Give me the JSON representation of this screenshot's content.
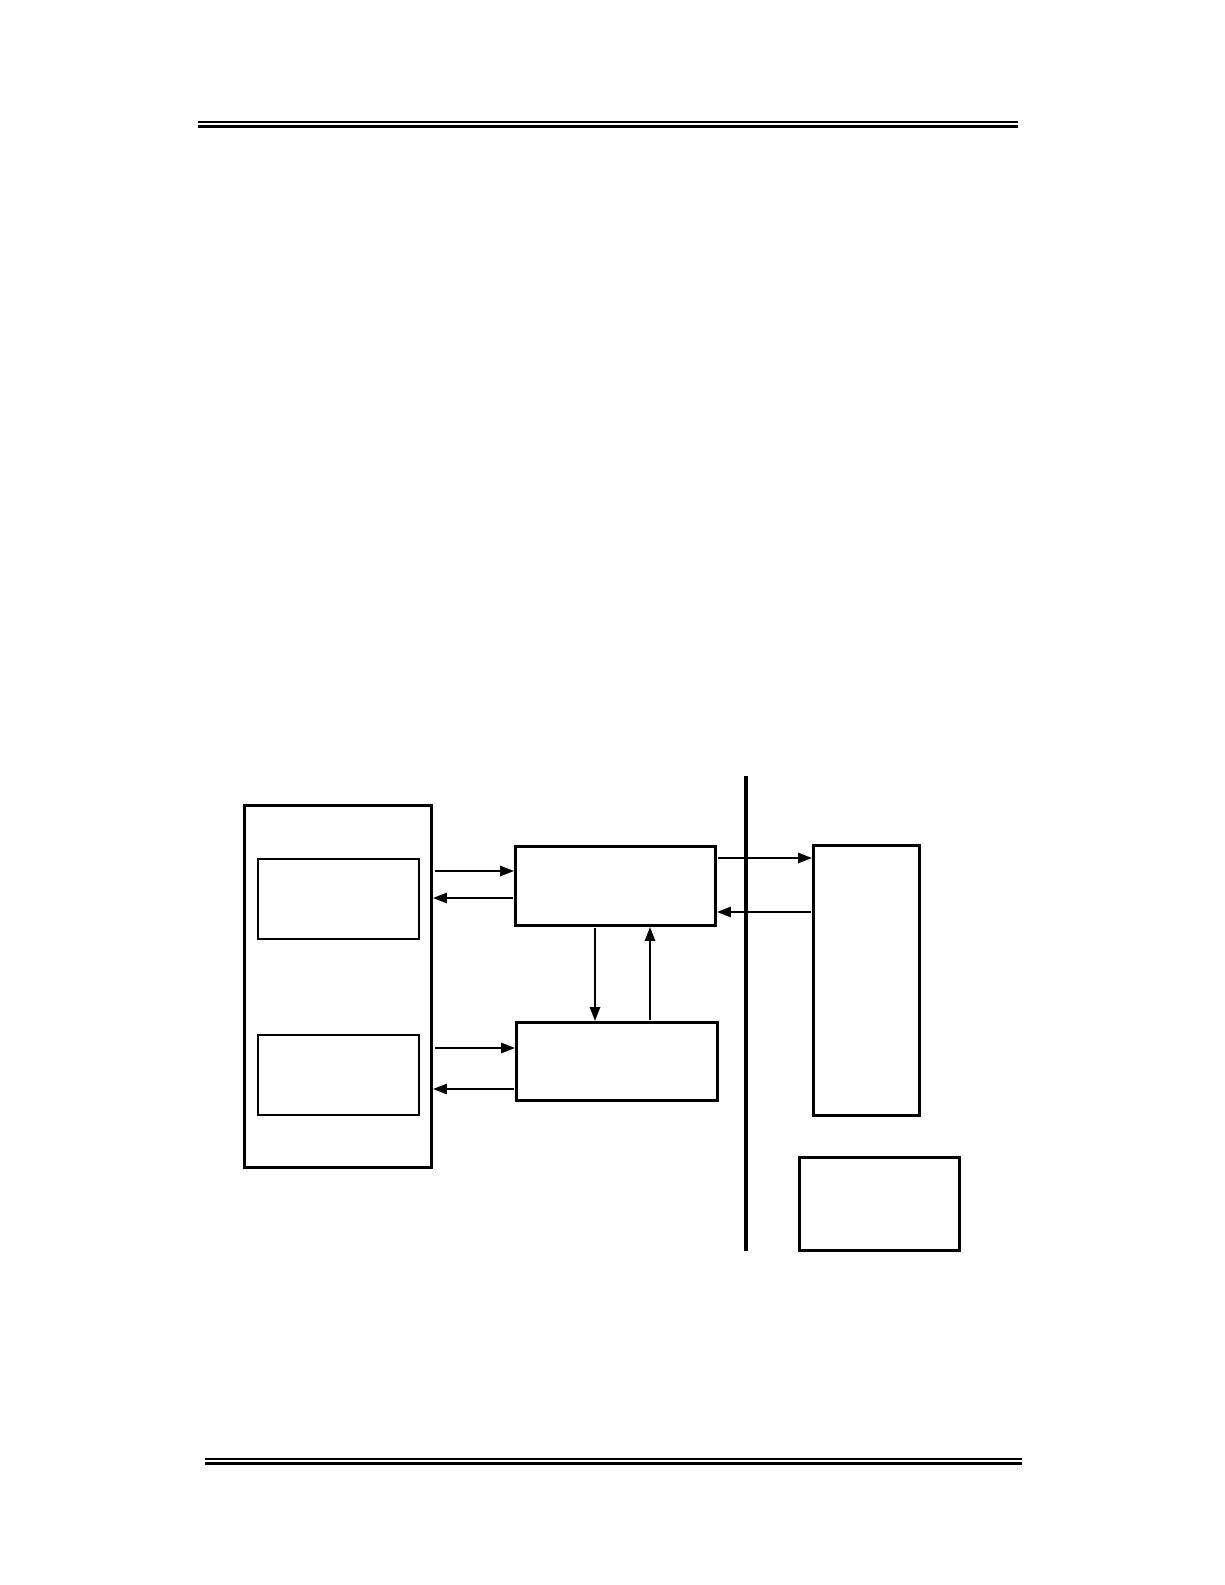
{
  "page": {
    "background_color": "#ffffff",
    "line_color": "#000000",
    "header_rule": "double-line",
    "footer_rule": "double-line"
  },
  "diagram": {
    "description": "block-diagram-with-empty-unlabeled-boxes",
    "nodes": [
      {
        "id": "left-outer-box",
        "label": ""
      },
      {
        "id": "left-inner-top-box",
        "label": ""
      },
      {
        "id": "left-inner-bottom-box",
        "label": ""
      },
      {
        "id": "middle-top-box",
        "label": ""
      },
      {
        "id": "middle-bottom-box",
        "label": ""
      },
      {
        "id": "right-tall-box",
        "label": ""
      },
      {
        "id": "bottom-right-box",
        "label": ""
      }
    ],
    "divider": {
      "id": "vertical-divider-line",
      "orientation": "vertical"
    },
    "connections": [
      {
        "from": "left-outer-box",
        "to": "middle-top-box",
        "arrow": "right"
      },
      {
        "from": "middle-top-box",
        "to": "left-outer-box",
        "arrow": "left"
      },
      {
        "from": "left-outer-box",
        "to": "middle-bottom-box",
        "arrow": "right"
      },
      {
        "from": "middle-bottom-box",
        "to": "left-outer-box",
        "arrow": "left"
      },
      {
        "from": "middle-top-box",
        "to": "middle-bottom-box",
        "arrow": "down"
      },
      {
        "from": "middle-bottom-box",
        "to": "middle-top-box",
        "arrow": "up"
      },
      {
        "from": "middle-top-box",
        "to": "right-tall-box",
        "arrow": "right",
        "crosses_divider": true
      },
      {
        "from": "right-tall-box",
        "to": "middle-top-box",
        "arrow": "left",
        "crosses_divider": true
      }
    ]
  }
}
